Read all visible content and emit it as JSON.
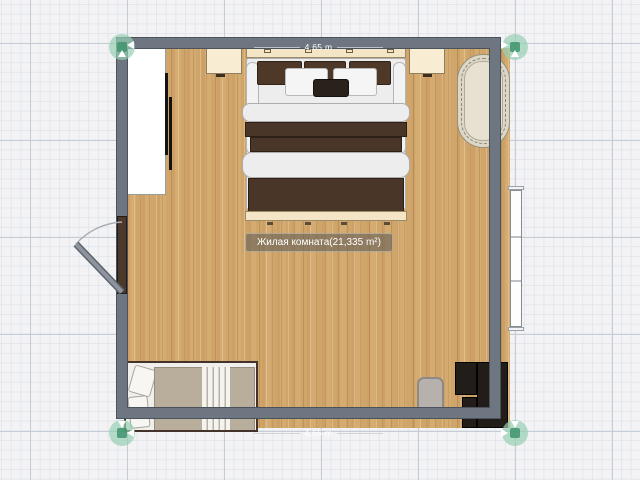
{
  "app": {
    "view": "floor-plan-editor-2d"
  },
  "room": {
    "label": "Жилая комната(21,335 m²)",
    "area_text": "21,335 m²",
    "dimension_top": "4,65 m",
    "dimension_bottom": "4,65 m"
  },
  "colors": {
    "wall": "#6e7781",
    "wall_edge": "#4a525b",
    "floor_wood": "#d0a76d",
    "corner_handle_green": "#3e946c",
    "blanket_dark_brown": "#4a3628",
    "headboard_cream": "#f3e5c6",
    "rug_cream": "#e7e1d2",
    "single_bed_blanket": "#b9ad9b",
    "desk_black": "#221d18",
    "grid_major": "#c6ccd6",
    "grid_minor": "#e3e6eb"
  },
  "objects": {
    "wardrobe": "white-wardrobe",
    "nightstand_left": "nightstand",
    "nightstand_right": "nightstand",
    "double_bed": "double-bed-brown-blanket",
    "oval_rug": "oval-rug",
    "door": "door-swing-left-wall",
    "window": "window-right-wall",
    "single_bed": "single-bed-bottom-left",
    "desk": "black-corner-desk",
    "pouf": "gray-pouf"
  }
}
